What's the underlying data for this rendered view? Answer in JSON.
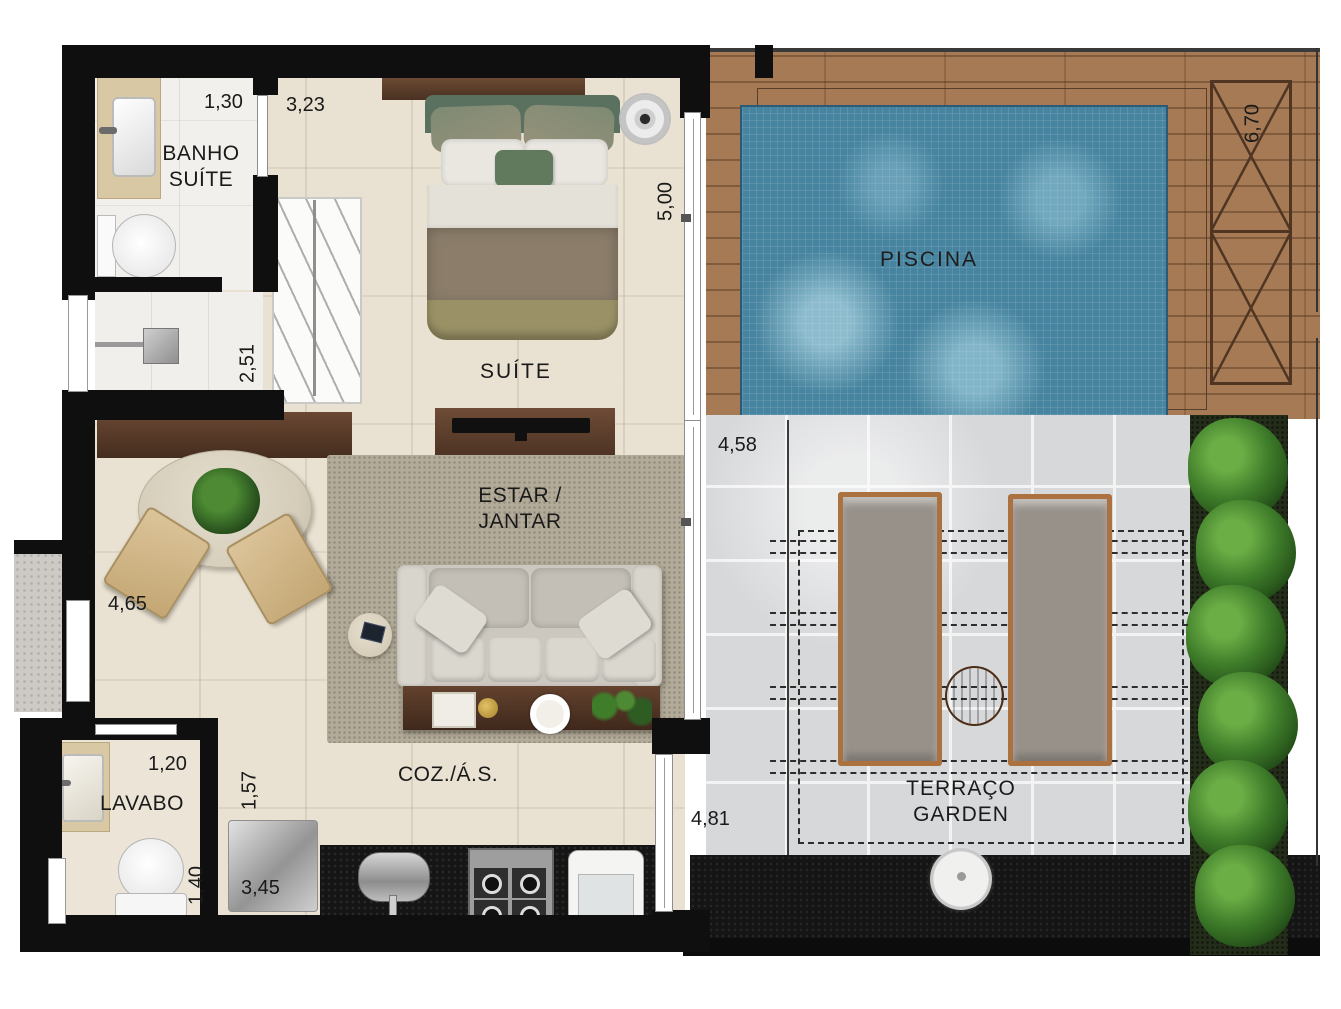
{
  "rooms": {
    "banho": {
      "line1": "BANHO",
      "line2": "SUÍTE"
    },
    "suite": {
      "label": "SUÍTE"
    },
    "estar": {
      "line1": "ESTAR /",
      "line2": "JANTAR"
    },
    "coz": {
      "label": "COZ./Á.S."
    },
    "lavabo": {
      "label": "LAVABO"
    },
    "piscina": {
      "label": "PISCINA"
    },
    "terraco": {
      "line1": "TERRAÇO",
      "line2": "GARDEN"
    }
  },
  "dims": {
    "d_1_30": "1,30",
    "d_3_23": "3,23",
    "d_5_00": "5,00",
    "d_6_70": "6,70",
    "d_2_51": "2,51",
    "d_4_58": "4,58",
    "d_4_65": "4,65",
    "d_1_20": "1,20",
    "d_1_57": "1,57",
    "d_1_40": "1,40",
    "d_3_45": "3,45",
    "d_4_81": "4,81"
  },
  "colors": {
    "wall": "#0f0f0f",
    "apartment_floor": "#e9e1d1",
    "pool_water": "#47849f",
    "wood_deck": "#a57a54",
    "terrace_tile": "#d7d8da",
    "granite": "#151515",
    "plant_green": "#3f7d2a",
    "dark_wood_furniture": "#5a3c28"
  }
}
